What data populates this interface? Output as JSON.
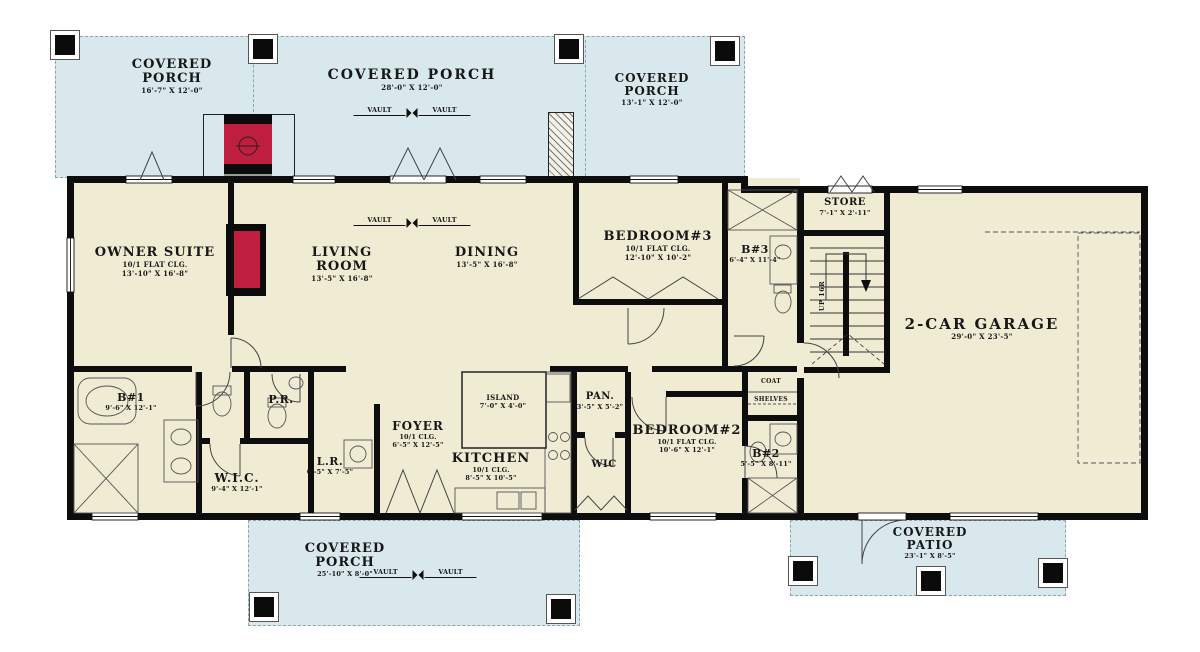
{
  "plan_type": "first-floor-plan",
  "colors": {
    "porch_fill": "#d8e8ec",
    "floor_fill": "#f0ebd3",
    "wall": "#0d0d0d",
    "fireplace_red": "#bf1e3e"
  },
  "porches": {
    "top_left": {
      "line1": "COVERED",
      "line2": "PORCH",
      "dims": "16'-7\" X 12'-0\""
    },
    "top_middle": {
      "name": "COVERED PORCH",
      "dims": "28'-0\" X 12'-0\""
    },
    "top_right": {
      "line1": "COVERED",
      "line2": "PORCH",
      "dims": "13'-1\" X 12'-0\""
    },
    "bottom": {
      "line1": "COVERED",
      "line2": "PORCH",
      "dims": "25'-10\" X 8'-0\""
    },
    "patio": {
      "line1": "COVERED",
      "line2": "PATIO",
      "dims": "23'-1\" X 8'-5\""
    }
  },
  "rooms": {
    "owner_suite": {
      "name": "OWNER SUITE",
      "ceiling": "10/1 FLAT CLG.",
      "dims": "13'-10\" X 16'-8\""
    },
    "living_room": {
      "line1": "LIVING",
      "line2": "ROOM",
      "dims": "13'-5\" X 16'-8\""
    },
    "dining": {
      "name": "DINING",
      "dims": "13'-5\" X 16'-8\""
    },
    "bedroom3": {
      "name": "BEDROOM#3",
      "ceiling": "10/1 FLAT CLG.",
      "dims": "12'-10\" X 10'-2\""
    },
    "bath3": {
      "name": "B#3",
      "dims": "6'-4\" X 11'-4\""
    },
    "store": {
      "name": "STORE",
      "dims": "7'-1\" X 2'-11\""
    },
    "garage": {
      "name": "2-CAR GARAGE",
      "dims": "29'-0\" X 23'-5\""
    },
    "bath1": {
      "name": "B#1",
      "dims": "9'-6\" X 12'-1\""
    },
    "powder_room": {
      "name": "P.R."
    },
    "wic1": {
      "name": "W.I.C.",
      "dims": "9'-4\" X 12'-1\""
    },
    "laundry": {
      "name": "L.R.",
      "dims": "6'-5\" X 7'-5\""
    },
    "foyer": {
      "name": "FOYER",
      "ceiling": "10/1 CLG.",
      "dims": "6'-5\" X 12'-5\""
    },
    "kitchen": {
      "name": "KITCHEN",
      "ceiling": "10/1 CLG.",
      "dims": "8'-5\" X 10'-5\""
    },
    "island": {
      "name": "ISLAND",
      "dims": "7'-0\" X 4'-0\""
    },
    "pantry": {
      "name": "PAN.",
      "dims": "3'-5\" X 5'-2\""
    },
    "wic2": {
      "name": "WIC"
    },
    "bedroom2": {
      "name": "BEDROOM#2",
      "ceiling": "10/1 FLAT CLG.",
      "dims": "10'-6\" X 12'-1\""
    },
    "bath2": {
      "name": "B#2",
      "dims": "5'-5\" X 8'-11\""
    },
    "coat": {
      "name": "COAT"
    },
    "shelves": {
      "name": "SHELVES"
    }
  },
  "annotations": {
    "vault": "VAULT",
    "up": "UP 16R"
  }
}
